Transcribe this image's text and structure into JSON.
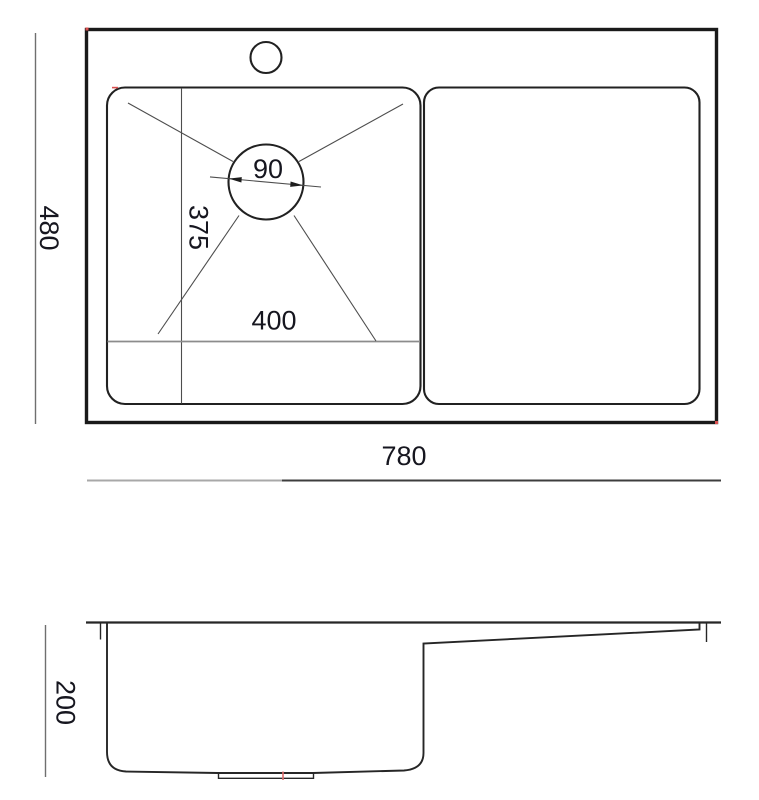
{
  "drawing": {
    "top_view": {
      "overall_width_label": "780",
      "overall_depth_label": "480",
      "bowl_width_label": "400",
      "bowl_depth_label": "375",
      "drain_diameter_label": "90"
    },
    "side_view": {
      "height_label": "200"
    },
    "dimensions_mm": {
      "overall_width": 780,
      "overall_depth": 480,
      "bowl_width": 400,
      "bowl_depth": 375,
      "drain_diameter": 90,
      "height": 200
    },
    "colors": {
      "outline": "#1a1a1a",
      "medium_line": "#212121",
      "thin_line": "#4d4d4d",
      "dim_gray": "#8c8c8c",
      "text": "#16161f",
      "artifact_red": "#d94f4f",
      "background": "#ffffff"
    }
  }
}
